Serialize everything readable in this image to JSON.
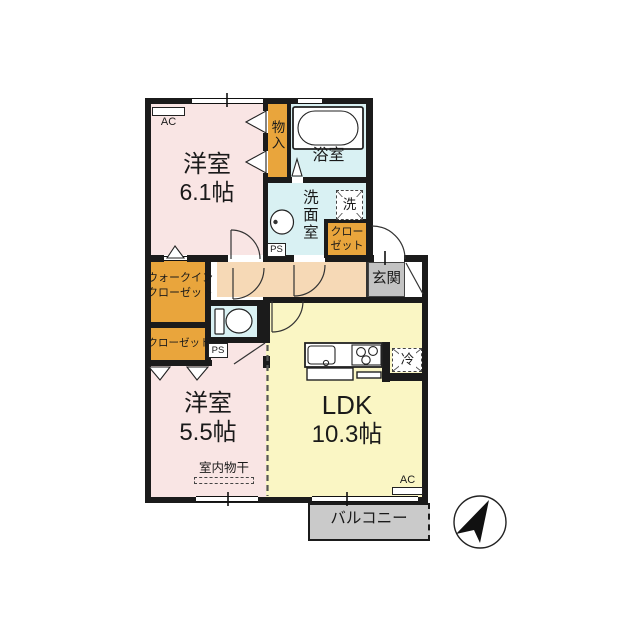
{
  "title": "2LDK floor plan",
  "colors": {
    "wall": "#1b1b1b",
    "room_pink": "#f9e5e4",
    "ldk_yellow": "#faf6c4",
    "wet_cyan": "#d9f1f3",
    "closet_orange": "#e9a53c",
    "hall_peach": "#f6d9b6",
    "entrance_gray": "#c3c3c3",
    "balcony_gray": "#cacaca"
  },
  "labels": {
    "ac": "AC",
    "ps": "PS"
  },
  "rooms": {
    "western1": {
      "name": "洋室",
      "size": "6.1帖"
    },
    "western2": {
      "name": "洋室",
      "size": "5.5帖"
    },
    "ldk": {
      "name": "LDK",
      "size": "10.3帖"
    },
    "bath": {
      "name": "浴室"
    },
    "washroom": {
      "name": "洗面室"
    },
    "storage": {
      "name": "物入"
    },
    "wic": {
      "line1": "ウォークイン",
      "line2": "クローゼット"
    },
    "closet_west": {
      "name": "クローゼット"
    },
    "closet_hall": {
      "line1": "クロー",
      "line2": "ゼット"
    },
    "entrance": {
      "name": "玄関"
    },
    "balcony": {
      "name": "バルコニー"
    }
  },
  "fixtures": {
    "washer": "洗",
    "fridge": "冷",
    "indoor_drying": "室内物干"
  }
}
